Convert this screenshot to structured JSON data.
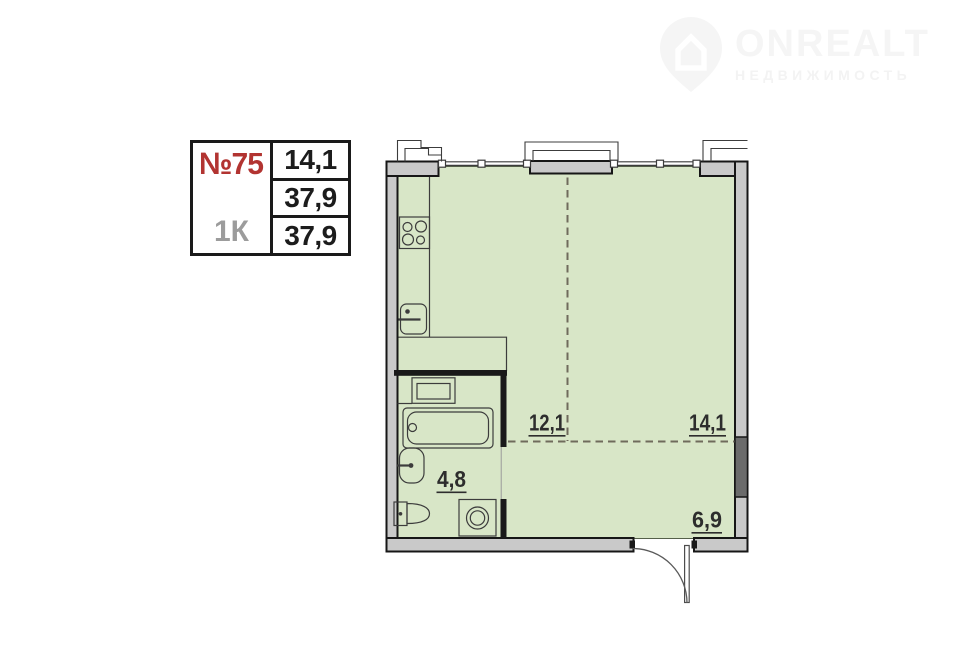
{
  "logo": {
    "brand": "ONREALT",
    "subtitle": "НЕДВИЖИМОСТЬ"
  },
  "info_table": {
    "unit_number": "№75",
    "unit_type": "1К",
    "values": [
      "14,1",
      "37,9",
      "37,9"
    ]
  },
  "floor_plan": {
    "labels": {
      "kitchen_zone": "12,1",
      "living_zone": "14,1",
      "bathroom": "4,8",
      "hallway": "6,9"
    }
  },
  "colors": {
    "accent_red": "#b23431",
    "type_gray": "#9c9c9c",
    "floor_green": "#d8e6c7",
    "wall_gray": "#c9c9c9",
    "shaft_gray": "#6b6b6b",
    "logo_gray": "#f5f5f5"
  }
}
